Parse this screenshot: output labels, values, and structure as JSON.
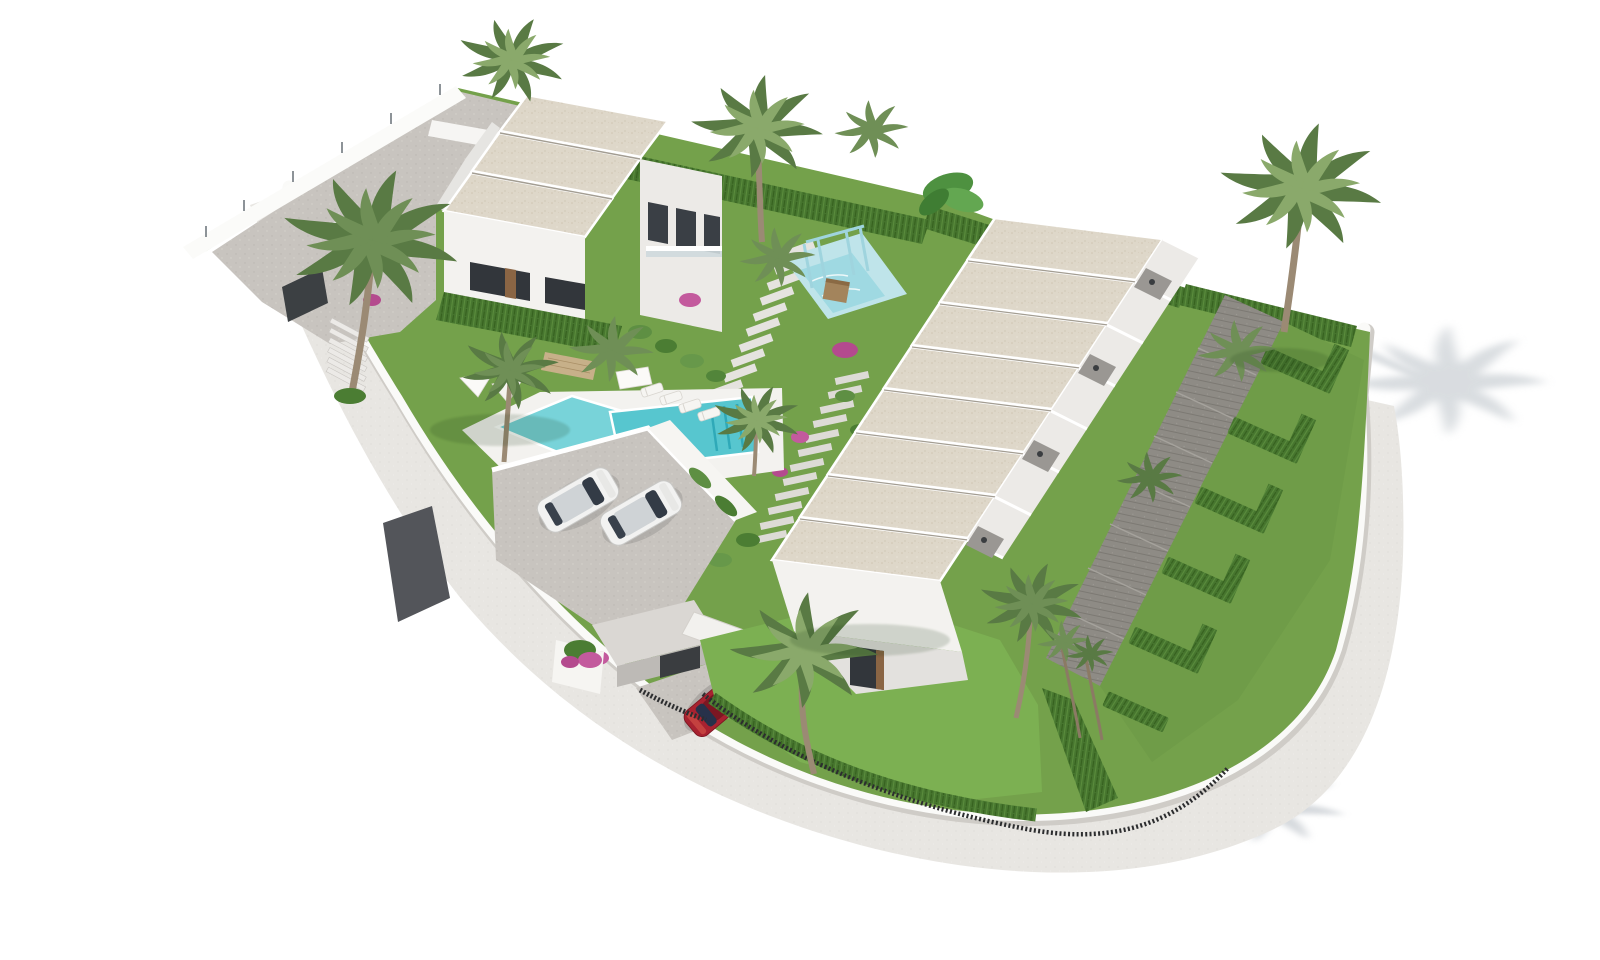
{
  "scene": {
    "kind": "3d-architectural-rendering",
    "view": "aerial isometric",
    "subject": "modern white residential development with gardens, pools and palm trees on a white backdrop"
  },
  "palette": {
    "background": "#ffffff",
    "grass": "#74a14b",
    "grass_bright": "#7cb052",
    "grass_corner": "#6f9c48",
    "hedge": "#47762f",
    "hedge_dark": "#365f20",
    "roof": "#ded7c9",
    "roof_speck": "#cfc5b2",
    "wall_white": "#f3f2ef",
    "wall_shade": "#dcdad6",
    "wall_dark_face": "#c9c7c3",
    "paving": "#c8c4bf",
    "retaining_wall_dark": "#53555a",
    "street": "#e8e6e2",
    "perimeter_wall": "#fafaf8",
    "gravel_path": "#8e8b85",
    "pool_water": "#57c6cf",
    "pool_water_light": "#78d3d9",
    "pool_step_line": "#2fa9b8",
    "splash_deck": "#bfe4ea",
    "splash_water": "#9fd9e2",
    "pergola_blue": "#9fd4de",
    "stone_wall_tan": "#c7b089",
    "palm_green": "#6f8f56",
    "palm_green_light": "#8aa96b",
    "palm_green_dark": "#597a44",
    "trunk_brown": "#9b8a74",
    "shadow_gray": "#ccd1d6",
    "car_white": "#f2f2f1",
    "car_red": "#a82230",
    "car_glass": "#333b46",
    "fence_black": "#2c2d2f",
    "flower_pink": "#c35a9d",
    "window_dark": "#32363b",
    "wood_brown": "#8a6544",
    "play_wood": "#a3845c"
  },
  "site": {
    "left_villa": {
      "roof_tiers": 3,
      "floors": 2,
      "balcony_openings": 3
    },
    "townhouse_row": {
      "units": 8,
      "rear_terraces": 8,
      "private_gardens": 6
    },
    "main_pool": {
      "shape": "offset rectangles",
      "loungers": 4,
      "parasols": 3
    },
    "kids_splash_pool": {
      "pergola": true,
      "wood_play_tower": true
    },
    "parking": {
      "white_cars": 2
    },
    "driveway_top": {
      "white_cars": 1
    },
    "entrance": {
      "gatehouse": true,
      "red_cars": 1,
      "black_gate": true
    },
    "perimeter": {
      "curved_street": true,
      "white_wall": true,
      "black_picket_fence": true
    },
    "vegetation": {
      "palm_trees": 14,
      "cypress_hedges": true,
      "bougainvillea_clusters": 6
    }
  }
}
